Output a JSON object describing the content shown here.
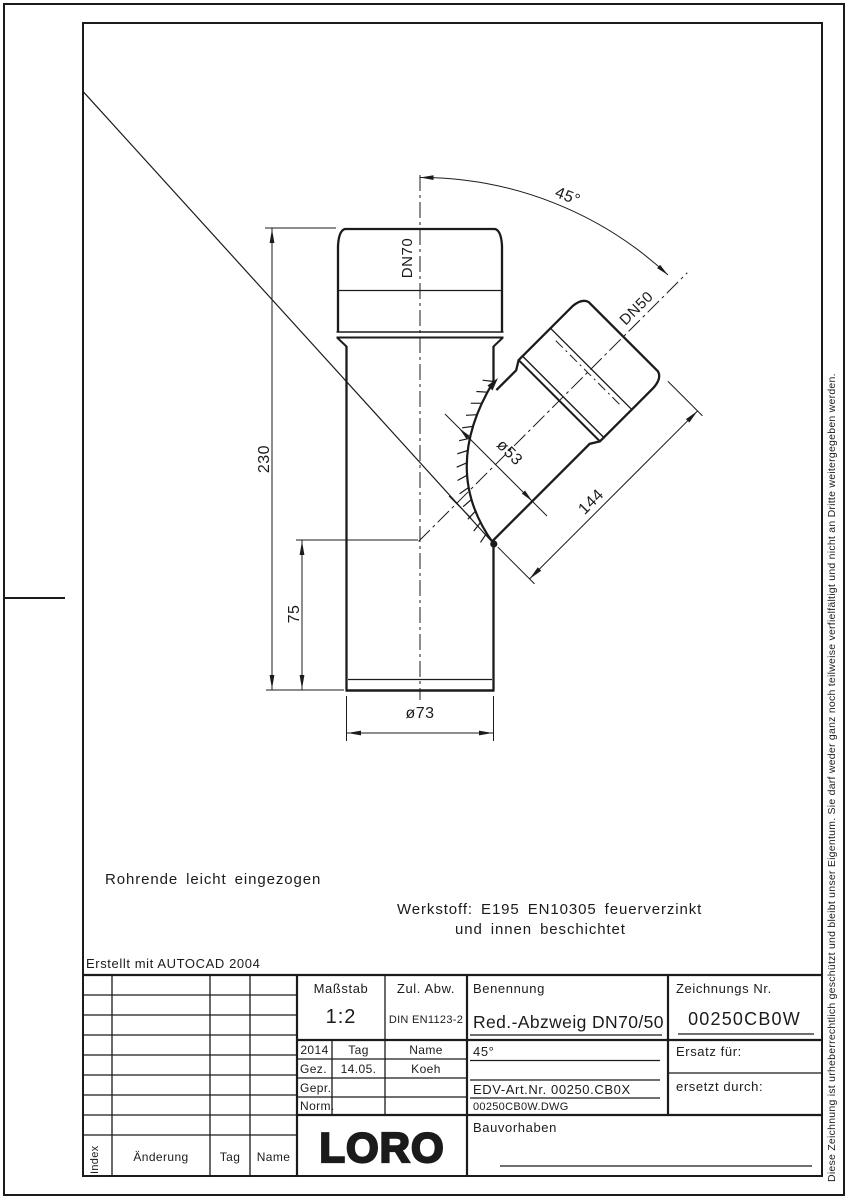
{
  "drawing": {
    "dims": {
      "height_total": "230",
      "height_branch": "75",
      "dia_main": "ø73",
      "dia_branch": "ø53",
      "len_branch": "144",
      "angle": "45°",
      "dn_main": "DN70",
      "dn_branch": "DN50"
    },
    "notes": {
      "note1": "Rohrende leicht eingezogen",
      "werkstoff_line1": "Werkstoff: E195 EN10305 feuerverzinkt",
      "werkstoff_line2": "und innen beschichtet",
      "created_with": "Erstellt mit AUTOCAD 2004"
    }
  },
  "titleblock": {
    "massstab_label": "Maßstab",
    "massstab_value": "1:2",
    "zul_abw_label": "Zul. Abw.",
    "zul_abw_value": "DIN EN1123-2",
    "benennung_label": "Benennung",
    "benennung_value": "Red.-Abzweig DN70/50",
    "zeichnungs_nr_label": "Zeichnungs Nr.",
    "zeichnungs_nr_value": "00250CB0W",
    "angle_value": "45°",
    "ersatz_fuer_label": "Ersatz für:",
    "edv_art_nr": "EDV-Art.Nr. 00250.CB0X",
    "dwg_file": "00250CB0W.DWG",
    "ersetzt_durch_label": "ersetzt durch:",
    "bauvorhaben_label": "Bauvorhaben",
    "logo_text": "LORO",
    "year": "2014",
    "tag_label": "Tag",
    "name_label": "Name",
    "gez_label": "Gez.",
    "gez_tag": "14.05.",
    "gez_name": "Koeh",
    "gepr_label": "Gepr.",
    "norm_label": "Norm.",
    "index_label": "Index",
    "aenderung_label": "Änderung",
    "tag_col_label": "Tag",
    "name_col_label": "Name"
  },
  "copyright_vertical": "Diese Zeichnung ist urheberrechtlich geschützt und bleibt unser Eigentum. Sie darf weder ganz noch teilweise verfielfältigt und nicht an Dritte weitergegeben werden."
}
